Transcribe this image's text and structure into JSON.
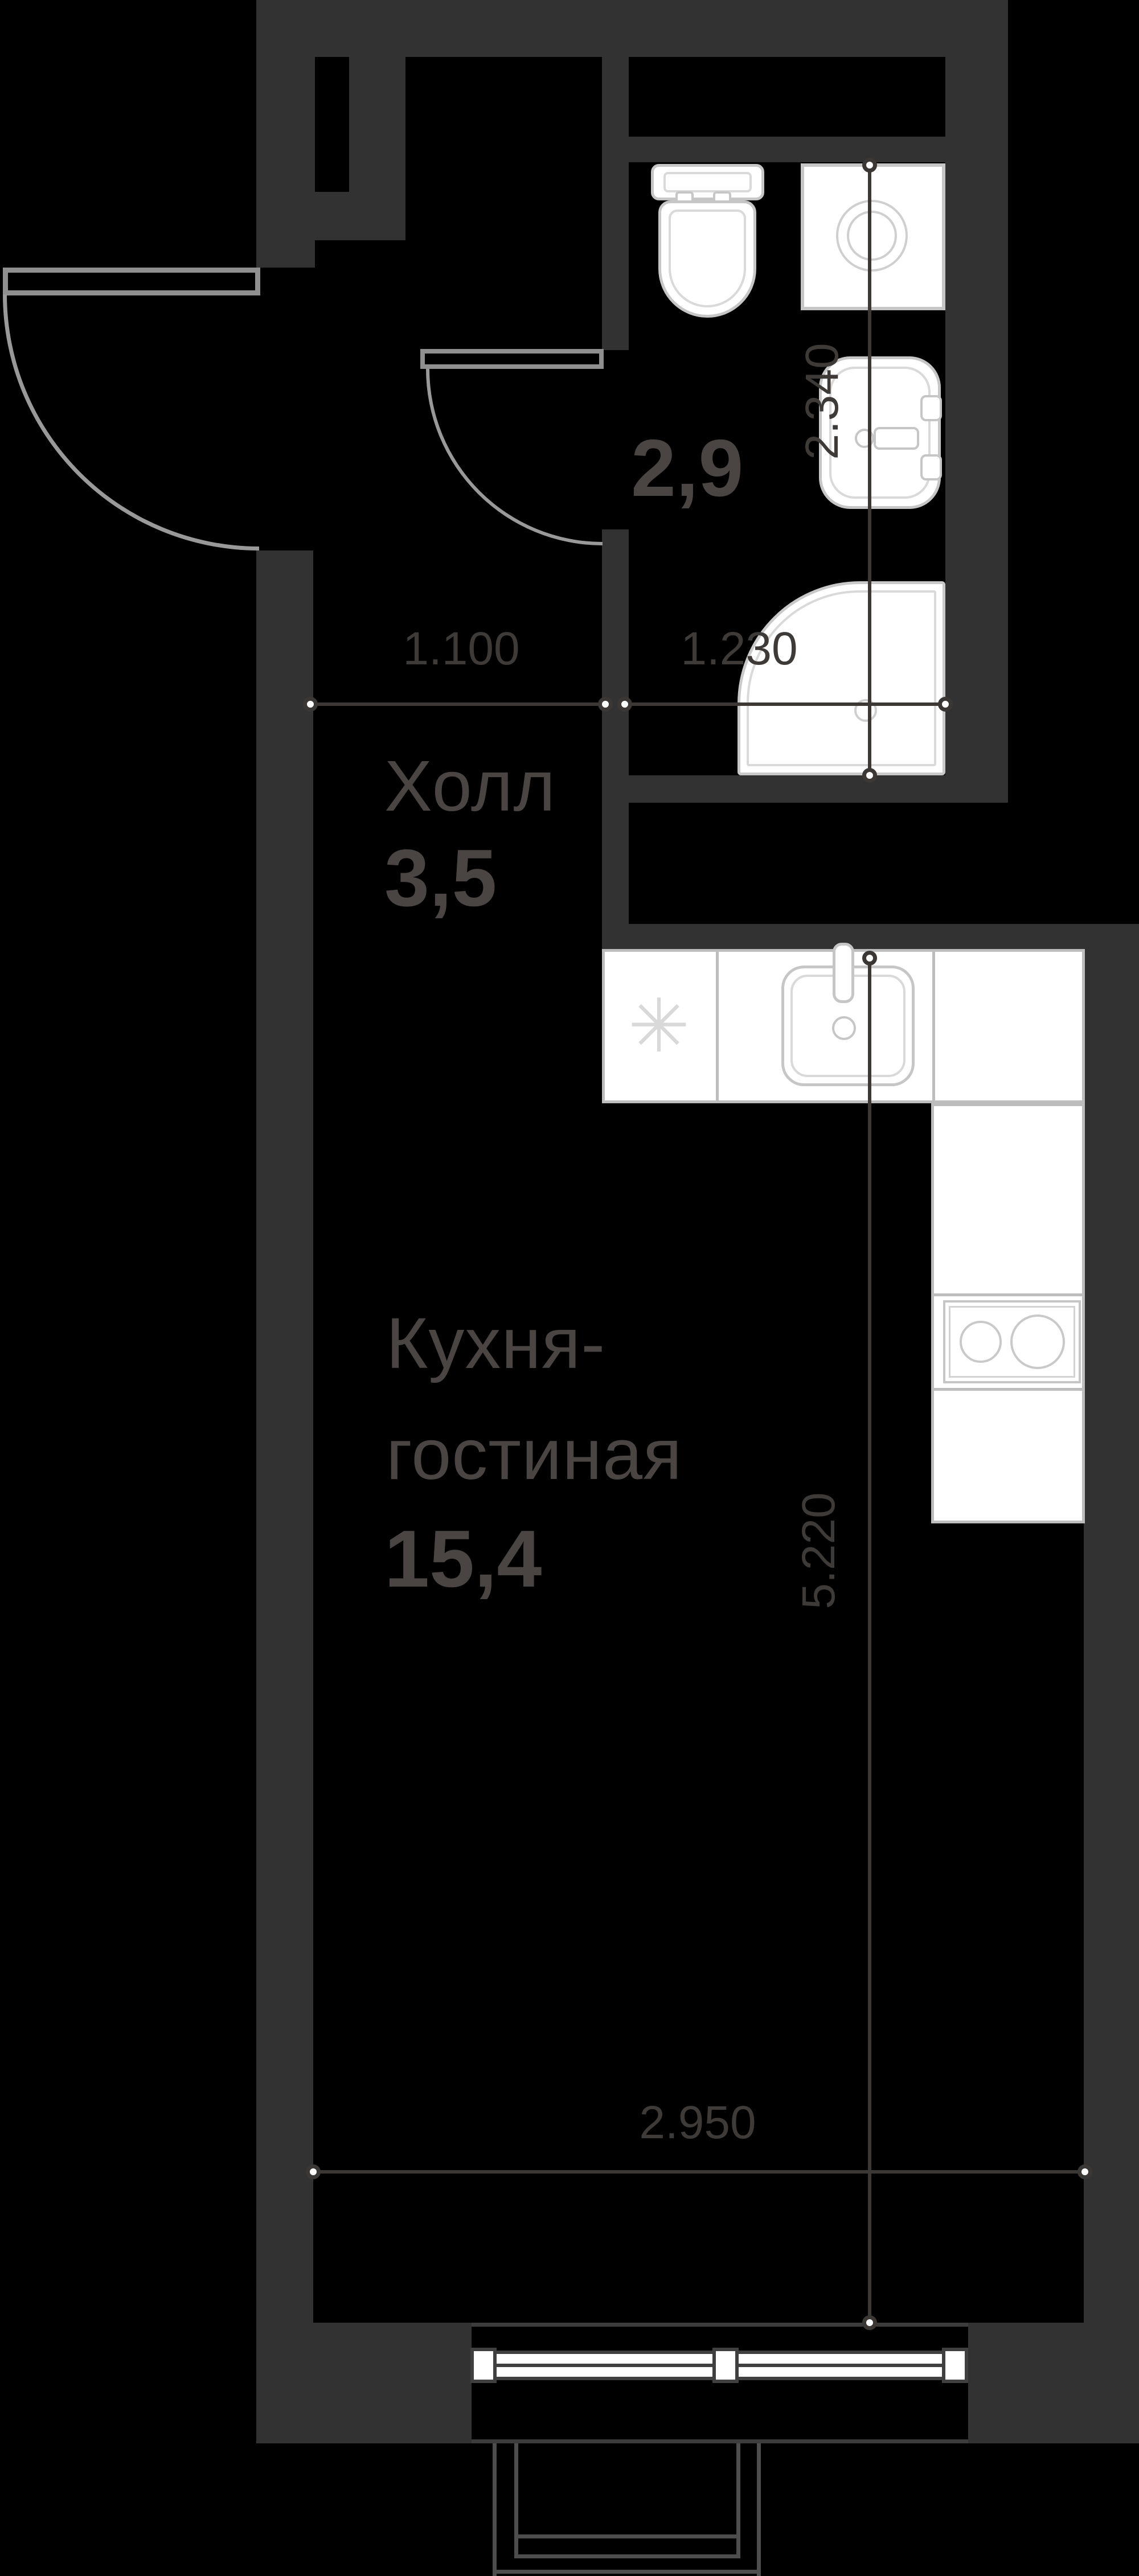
{
  "title": "Studio apartment floor plan",
  "rooms": {
    "hall": {
      "name": "Холл",
      "area": "3,5"
    },
    "kitchen_living": {
      "name_line1": "Кухня-",
      "name_line2": "гостиная",
      "area": "15,4"
    },
    "bathroom": {
      "area": "2,9"
    }
  },
  "dimensions": {
    "hall_width": "1.100",
    "bathroom_width": "1.230",
    "bathroom_depth": "2.340",
    "kitchen_depth": "5.220",
    "kitchen_width": "2.950"
  },
  "icons": {
    "fridge_symbol": "✳"
  },
  "colors": {
    "background": "#000000",
    "wall": "#333233",
    "fixture_stroke": "#c6c6c6",
    "dimension_line": "#3b3835",
    "label_text": "#4a4542",
    "dimension_text": "#3e3a37",
    "door_stroke": "#8f8f8f"
  }
}
